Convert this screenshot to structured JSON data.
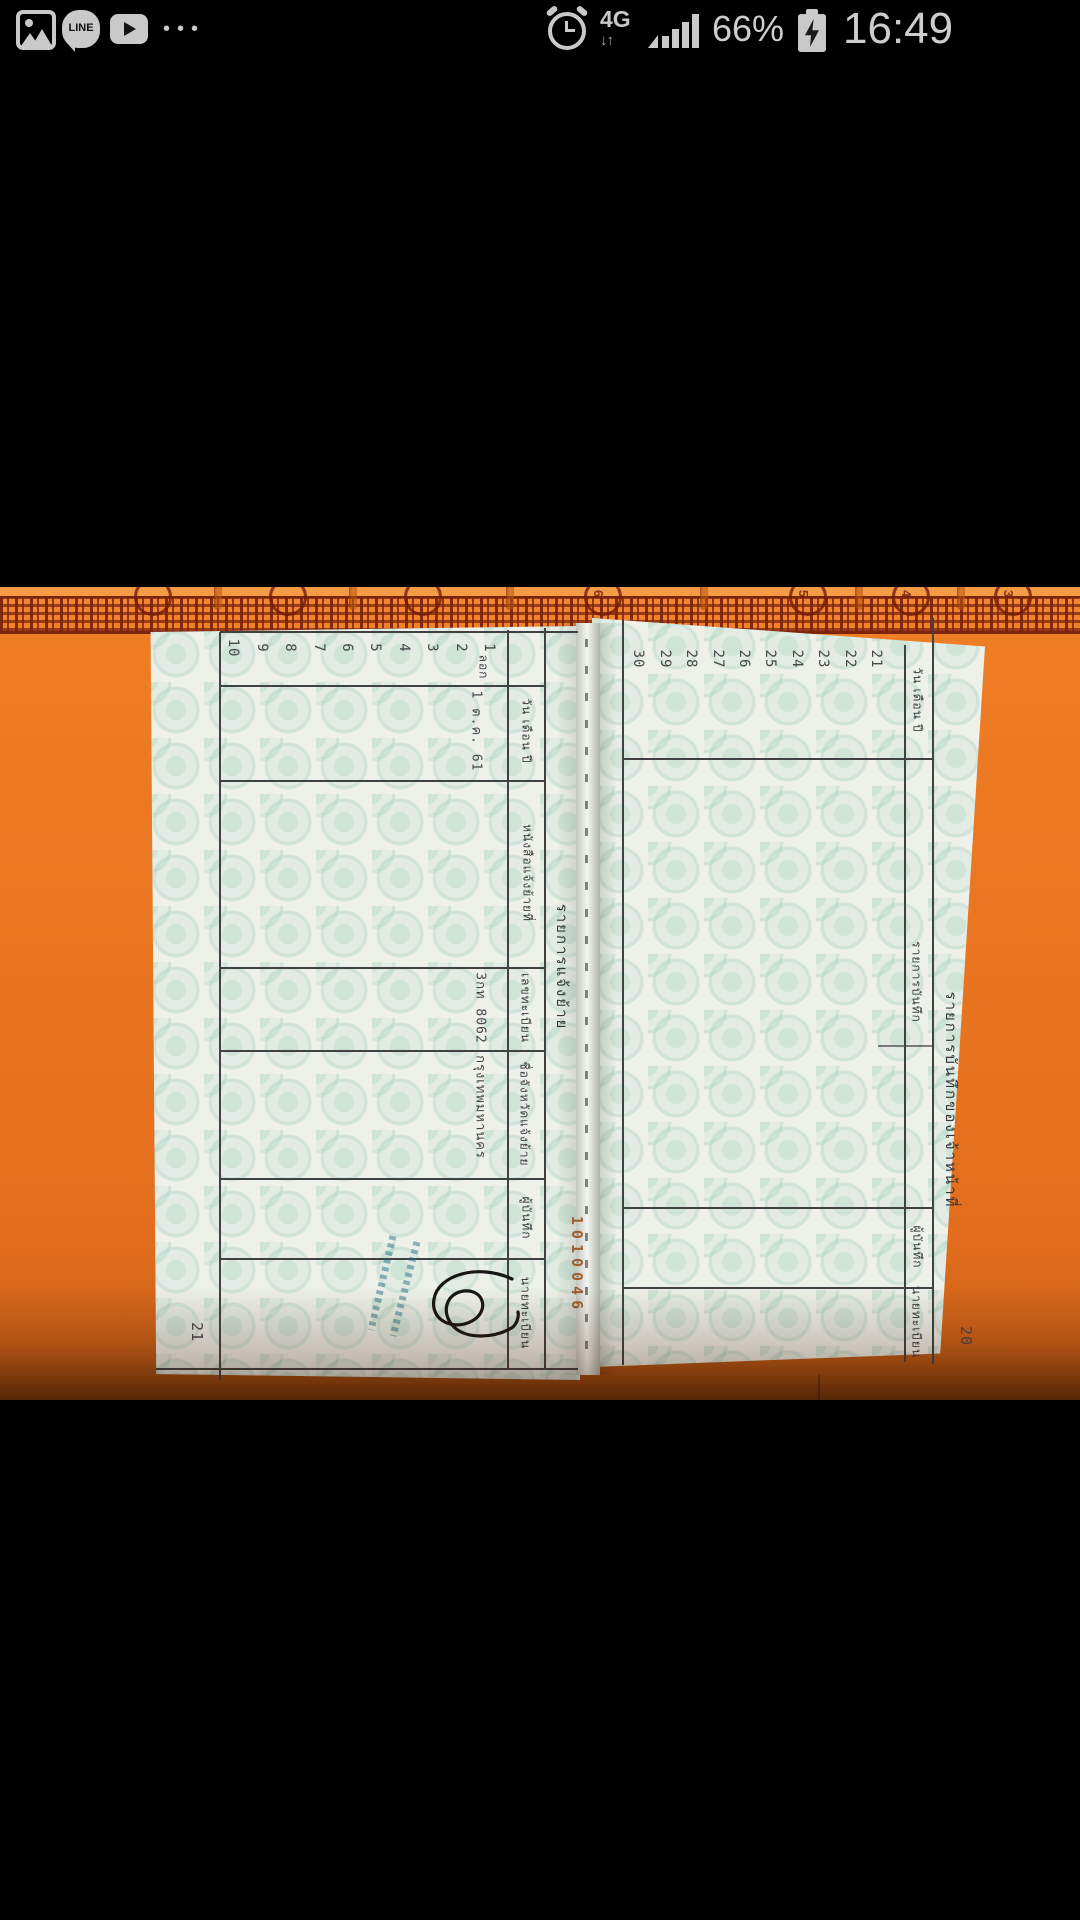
{
  "status_bar": {
    "time": "16:49",
    "battery_percent": "66%",
    "network": "4G",
    "line_label": "LINE",
    "more_dots": "•••",
    "icons": [
      "photos-app",
      "line-app",
      "youtube-app",
      "more-notifications",
      "alarm",
      "4g-data",
      "signal-full",
      "battery-charging"
    ]
  },
  "photo": {
    "cover": {
      "tab_numbers": [
        "6",
        "5",
        "4",
        "3"
      ],
      "serial_stamp": "1010046"
    },
    "left_page": {
      "page_number": "21",
      "title": "รายการแจ้งย้าย",
      "headers": [
        "วัน เดือน ปี",
        "หนังสือแจ้งย้ายที่",
        "เลขทะเบียน",
        "ชื่อจังหวัดแจ้งย้าย",
        "ผู้บันทึก",
        "นายทะเบียน"
      ],
      "row_numbers": [
        "1",
        "2",
        "3",
        "4",
        "5",
        "6",
        "7",
        "8",
        "9",
        "10"
      ],
      "row1": {
        "note": "ลอก",
        "date": "1 ต.ค. 61",
        "registration_no": "3กท 8062",
        "province": "กรุงเทพมหานคร",
        "registrar_signature": "handwritten signature",
        "registrar_stamp": "illegible blue ink name stamp"
      }
    },
    "right_page": {
      "page_number": "20",
      "title": "รายการบันทึกของเจ้าหน้าที่",
      "headers": [
        "วัน เดือน ปี",
        "รายการบันทึก",
        "ผู้บันทึก",
        "นายทะเบียน"
      ],
      "row_numbers": [
        "21",
        "22",
        "23",
        "24",
        "25",
        "26",
        "27",
        "28",
        "29",
        "30"
      ]
    }
  },
  "colors": {
    "cover_orange": "#e97420",
    "deco_maroon": "#7c2410",
    "paper": "#edf1ea",
    "grid_line": "#3f4144",
    "status_gray": "#c9c9c9"
  }
}
